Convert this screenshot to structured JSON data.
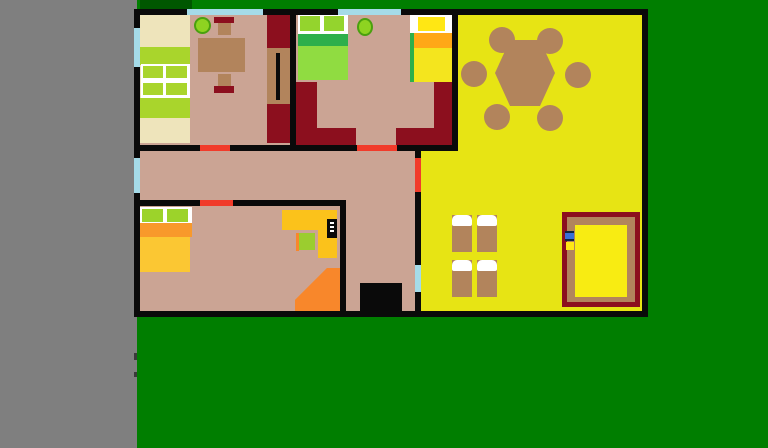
{
  "canvas": {
    "width": 768,
    "height": 448,
    "kind": "floor-plan drawing on green background"
  },
  "palette": {
    "gray_workspace": "#7F7F7F",
    "grass_green": "#007E00",
    "dark_green_accent": "#005700",
    "wall_black": "#0A0A0A",
    "floor_tan": "#CBA494",
    "window_cyan": "#A5DBE8",
    "door_red": "#F13B2A",
    "dark_red": "#8C0F1E",
    "wood_brown": "#B2845C",
    "living_yellow": "#E7E414",
    "cream": "#EEE4BB",
    "lime_green": "#A9D52C",
    "white": "#FFFFFF",
    "pillow_green": "#94D42D",
    "stripe_green": "#2EAF4B",
    "bed_body_green": "#90DC41",
    "pillow_yellow": "#FFE714",
    "stripe_orange": "#FFA817",
    "bed_body_yellow": "#F4E51E",
    "bed4_pillow_green": "#9CD32A",
    "bed4_stripe_orange": "#F8992B",
    "bed4_body": "#FBC733",
    "desk_yellow": "#FBC21B",
    "chair_green": "#9BCD2F",
    "bright_orange": "#F8872B",
    "mattress_yellow": "#F8EC12",
    "plant_green": "#8ED321",
    "plant_border": "#4AA00F",
    "icon_blue": "#3A6FD8"
  },
  "objects": {
    "rooms": [
      {
        "name": "bedroom-top-left"
      },
      {
        "name": "bedroom-top-middle"
      },
      {
        "name": "living-room-yellow"
      },
      {
        "name": "hallway"
      },
      {
        "name": "bedroom-bottom-left"
      }
    ],
    "furniture": {
      "shelf_bed": "cream shelf bed with green cushions",
      "dining_table": "brown table with two stools",
      "wardrobe": "dark red wardrobe with handle",
      "plant": "green potted plant",
      "bed_green": "double bed green",
      "bed_yellow": "double bed yellow",
      "sofa": "dark red corner sofa sections",
      "bed_orange": "bed with orange blanket",
      "corner_desk": "yellow corner desk",
      "tv": "black tv monitor",
      "desk_chair": "green chair",
      "hex_table": "hexagonal dining table with six round chairs",
      "single_beds": "four single beds with white pillows",
      "framed_bed": "large bed with dark red frame and yellow mattress"
    },
    "openings": {
      "doors_red": 4,
      "windows_cyan": 5,
      "entrance_black": 1
    }
  }
}
